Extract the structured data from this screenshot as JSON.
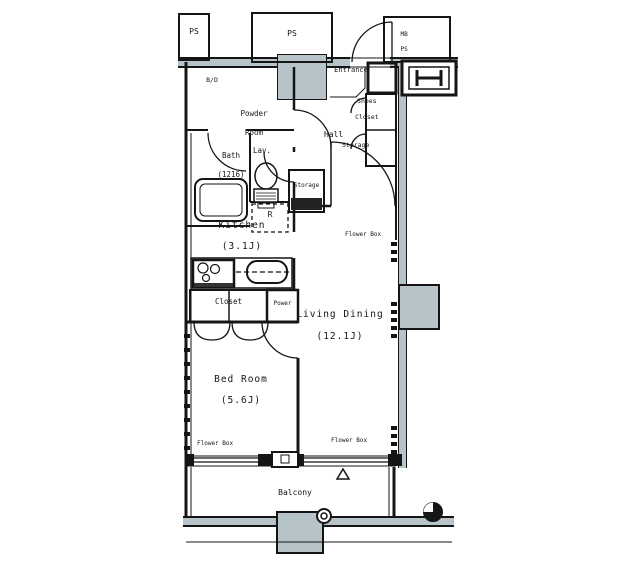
{
  "floor_plan": {
    "rooms": {
      "living_dining": {
        "name": "Living Dining",
        "size": "(12.1J)"
      },
      "bed_room": {
        "name": "Bed Room",
        "size": "(5.6J)"
      },
      "kitchen": {
        "name": "Kitchen",
        "size": "(3.1J)"
      },
      "bath": {
        "name": "Bath",
        "size": "(1216)"
      },
      "powder_room": {
        "line1": "Powder",
        "line2": "Room"
      },
      "lavatory": {
        "name": "Lav."
      },
      "hall": {
        "name": "Hall"
      },
      "entrance": {
        "name": "Entrance"
      },
      "balcony": {
        "name": "Balcony"
      }
    },
    "storage": {
      "closet": "Closet",
      "shoes_closet_line1": "Shoes",
      "shoes_closet_line2": "Closet",
      "hall_storage": "Storage",
      "lavatory_storage": "Storage",
      "power": "Power"
    },
    "utilities": {
      "ps_left": "PS",
      "ps_center": "PS",
      "mb": "MB",
      "ps_right": "PS",
      "bd": "B/D",
      "refrigerator": "R",
      "flower_box": "Flower Box"
    },
    "colors": {
      "wall_fill": "#b6c3c9",
      "line": "#151515",
      "background": "#ffffff"
    }
  }
}
